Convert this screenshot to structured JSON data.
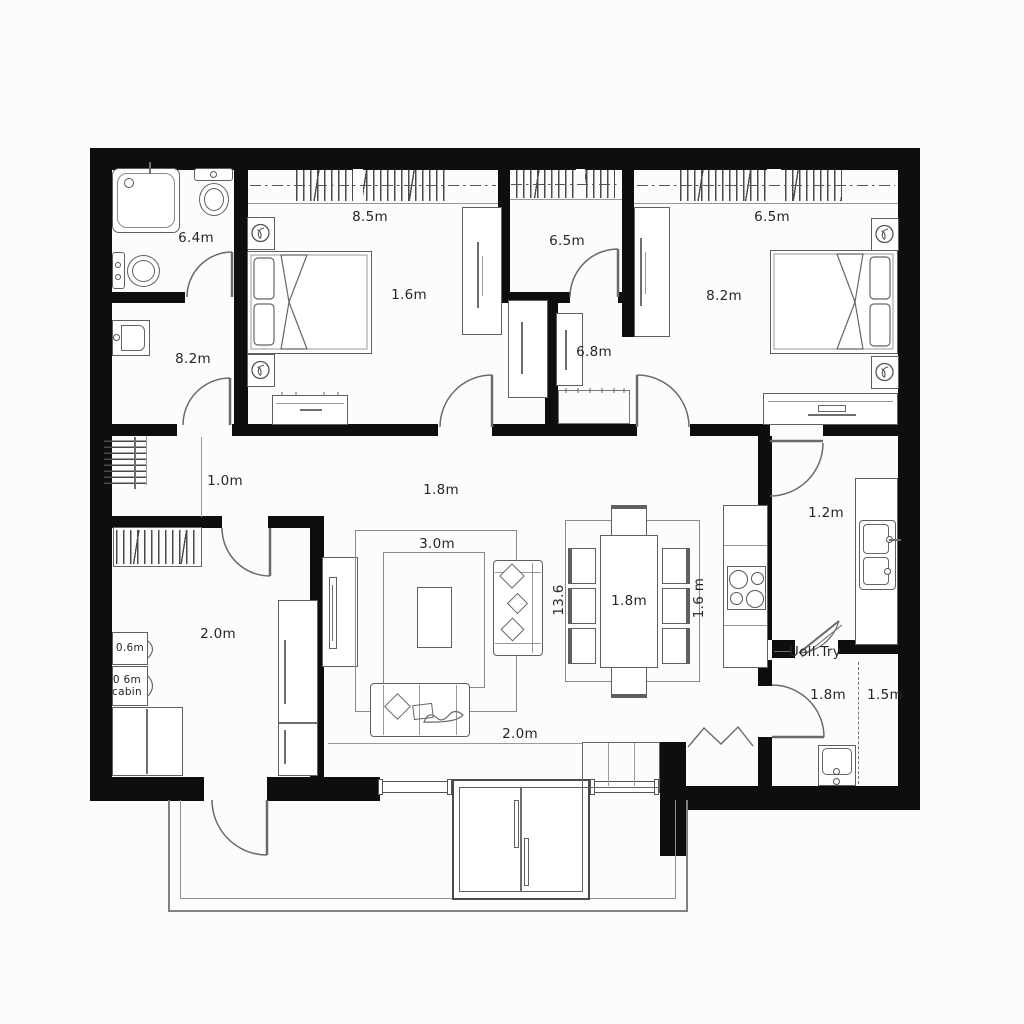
{
  "plan": {
    "type": "apartment-floor-plan",
    "colors": {
      "wall": "#0e0e0e",
      "furniture_line": "#5f5f5f",
      "thin_line": "#8a8a8a",
      "text": "#262626",
      "background": "#fcfcfc"
    },
    "rooms": {
      "bathroom": {
        "area": "6.4m"
      },
      "wc": {
        "area": "8.2m"
      },
      "bedroom1": {
        "width": "8.5m",
        "dim": "1.6m"
      },
      "closet": {
        "area": "6.5m"
      },
      "storage": {
        "area": "6.8m"
      },
      "bedroom2": {
        "width": "6.5m",
        "area": "8.2m"
      },
      "hallway": {
        "dim_a": "1.0m",
        "dim_b": "1.8m"
      },
      "dressing": {
        "area": "2.0m",
        "cabinet_a": "0.6m",
        "cabinet_b_line1": "0 6m",
        "cabinet_b_line2": "cabin"
      },
      "living": {
        "rug": "3.0m",
        "bottom": "2.0m"
      },
      "dining": {
        "table": "1.8m",
        "side_left": "13.6",
        "side_right": "1.6 m"
      },
      "kitchen": {
        "dim": "1.2m"
      },
      "utility": {
        "note": "Uoll.Try",
        "dim_a": "1.8m",
        "dim_b": "1.5m"
      }
    }
  }
}
